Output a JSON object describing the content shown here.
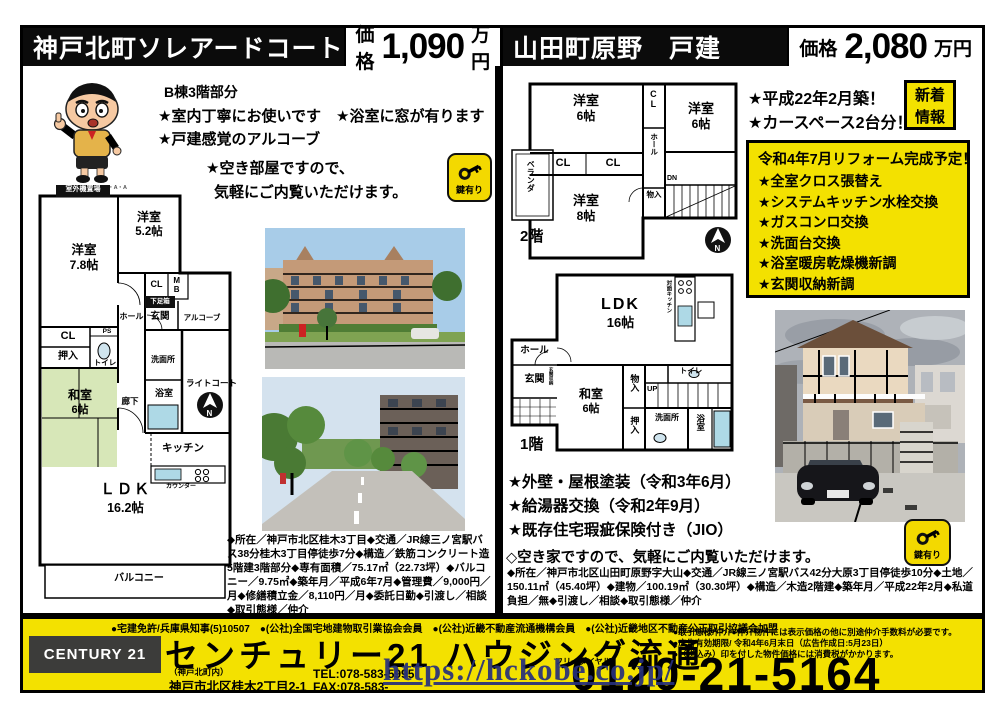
{
  "watermark": "https://hckobe.co.jp/",
  "left": {
    "title": "神戸北町ソレアードコート",
    "price_label": "価格",
    "price": "1,090",
    "price_unit": "万円",
    "unit_note": "B棟3階部分",
    "feature_line1": "★室内丁寧にお使いです　★浴室に窓が有ります",
    "feature_line2": "★戸建感覚のアルコーブ",
    "vacancy_line1": "★空き部屋ですので、",
    "vacancy_line2": "気軽にご内覧いただけます。",
    "mascot_credit": "©U/F・S・A・A",
    "key_badge": "鍵有り",
    "floorplan": {
      "outdoor_unit": "室外機置場",
      "room78_name": "洋室",
      "room78_size": "7.8帖",
      "room52_name": "洋室",
      "room52_size": "5.2帖",
      "cl_upper": "CL",
      "mb": "MB",
      "shoe_box": "下足箱",
      "entrance": "玄関",
      "alcove": "アルコーブ",
      "hall": "ホール",
      "ps": "PS",
      "cl_lower": "CL",
      "closet": "押入",
      "toilet": "トイレ",
      "tatami_name": "和室",
      "tatami_size": "6帖",
      "corridor": "廊下",
      "washroom": "洗面所",
      "bathroom": "浴室",
      "kitchen": "キッチン",
      "counter": "カウンター",
      "ldk_name": "ＬＤＫ",
      "ldk_size": "16.2帖",
      "balcony": "バルコニー",
      "light_court": "ライトコート",
      "north": "N"
    },
    "details": "◆所在／神戸市北区桂木3丁目◆交通／JR線三ノ宮駅バス38分桂木3丁目停徒歩7分◆構造／鉄筋コンクリート造5階建3階部分◆専有面積／75.17㎡（22.73坪）◆バルコニー／9.75㎡◆築年月／平成6年7月◆管理費／9,000円／月◆修繕積立金／8,110円／月◆委託日勤◆引渡し／相談◆取引態様／仲介"
  },
  "right": {
    "title": "山田町原野　戸建",
    "price_label": "価格",
    "price": "2,080",
    "price_unit": "万円",
    "new_badge_line1": "新着",
    "new_badge_line2": "情報",
    "feature_line1": "★平成22年2月築！",
    "feature_line2": "★カースペース2台分！",
    "reform_title": "令和4年7月リフォーム完成予定！",
    "reform_items": [
      "★全室クロス張替え",
      "★システムキッチン水栓交換",
      "★ガスコンロ交換",
      "★洗面台交換",
      "★浴室暖房乾燥機新調",
      "★玄関収納新調"
    ],
    "maintenance_items": [
      "★外壁・屋根塗装（令和3年6月）",
      "★給湯器交換（令和2年9月）",
      "★既存住宅瑕疵保険付き（JIO）"
    ],
    "vacancy_note": "◇空き家ですので、気軽にご内覧いただけます。",
    "key_badge": "鍵有り",
    "floor2": {
      "label": "2階",
      "veranda": "ベランダ",
      "room6a_name": "洋室",
      "room6a_size": "6帖",
      "cl_vert": "CL",
      "room6b_name": "洋室",
      "room6b_size": "6帖",
      "cl1": "CL",
      "cl2": "CL",
      "hall": "ホール",
      "room8_name": "洋室",
      "room8_size": "8帖",
      "dn": "DN",
      "storage": "物入",
      "north": "N"
    },
    "floor1": {
      "label": "1階",
      "ldk_name": "LDK",
      "ldk_size": "16帖",
      "kitchen_vert": "対面キッチン",
      "hall": "ホール",
      "entrance": "玄関",
      "entrance_storage": "玄関収納",
      "tatami_name": "和室",
      "tatami_size": "6帖",
      "storage1": "物入",
      "storage2": "押入",
      "up": "UP",
      "toilet": "トイレ",
      "washroom": "洗面所",
      "bathroom": "浴室"
    },
    "details": "◆所在／神戸市北区山田町原野字大山◆交通／JR線三ノ宮駅バス42分大原3丁目停徒歩10分◆土地／150.11㎡（45.40坪）◆建物／100.19㎡（30.30坪）◆構造／木造2階建◆築年月／平成22年2月◆私道負担／無◆引渡し／相談◆取引態様／仲介"
  },
  "footer": {
    "memberships": "●宅建免許/兵庫県知事(5)10507　●(公社)全国宅地建物取引業協会会員　●(公社)近畿不動産流通機構会員　●(公社)近畿地区不動産公正取引協議会加盟",
    "brand": "CENTURY 21",
    "company": "センチュリー21 ハウジング流通",
    "branch": "（神戸北町内）",
    "address": "神戸市北区桂木2丁目2-1",
    "tel": "TEL:078-583-5995",
    "fax": "FAX:078-583-",
    "free_dial_label": "フリーダイヤル",
    "phone": "0120-21-5164",
    "notes": [
      "●取引態様/仲介●仲介物件には表示価格の他に別途仲介手数料が必要です。",
      "●広告有効期限/ 令和4年6月末日（広告作成日:5月23日）",
      "●（税込み）印を付した物件価格には消費税がかかります。"
    ]
  }
}
